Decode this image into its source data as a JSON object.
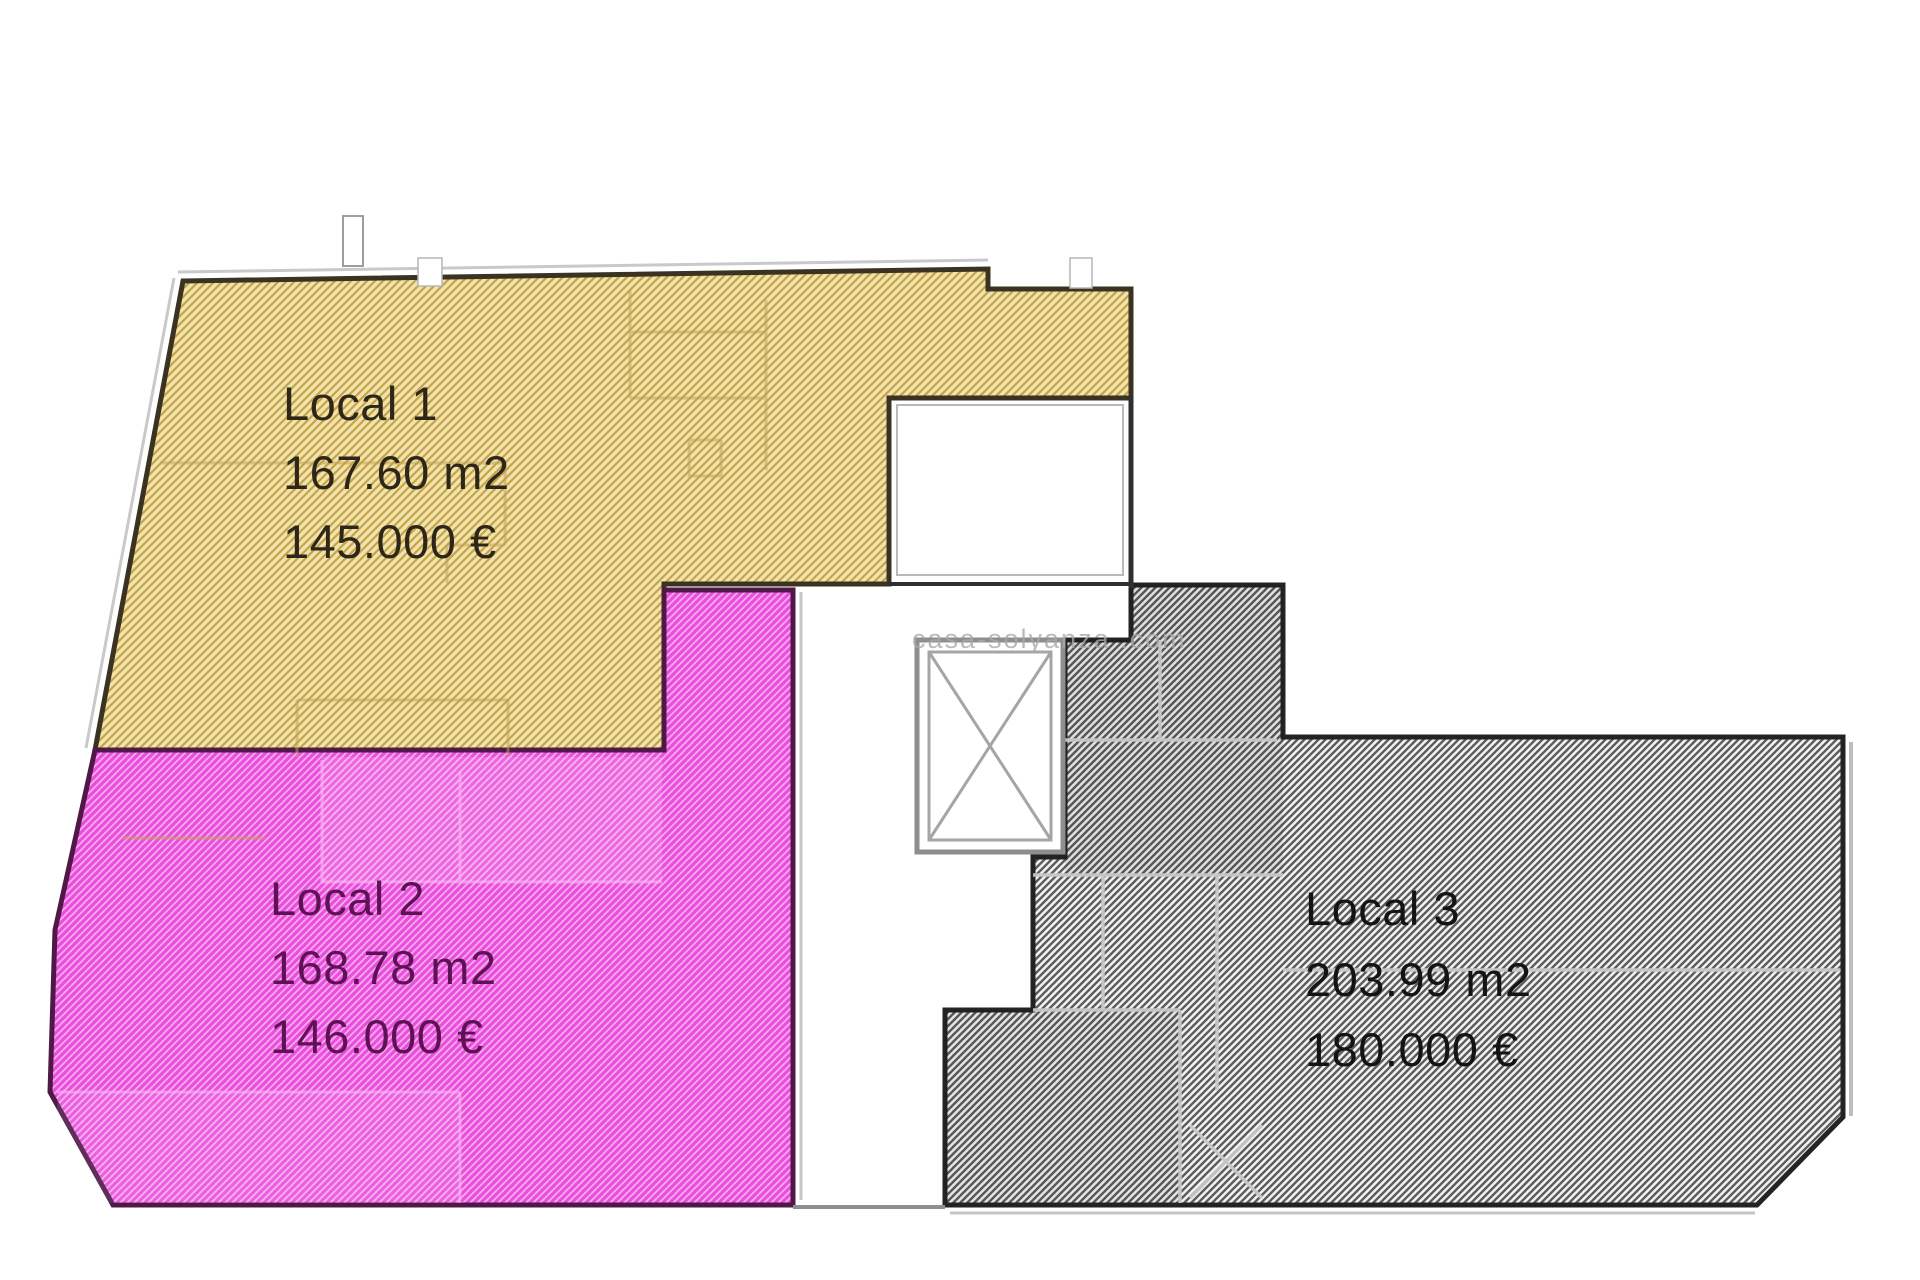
{
  "units": [
    {
      "id": "local-1",
      "name": "Local 1",
      "area": "167.60 m2",
      "price": "145.000 €",
      "colors": {
        "fill_bg": "#f1e4ab",
        "hatch_line": "#c5a24c",
        "border": "#3b3322",
        "text": "#2e2719"
      }
    },
    {
      "id": "local-2",
      "name": "Local 2",
      "area": "168.78 m2",
      "price": "146.000 €",
      "colors": {
        "fill_bg": "#ea4edc",
        "hatch_line": "#f7abef",
        "border": "#4f1847",
        "text": "#5d1254"
      }
    },
    {
      "id": "local-3",
      "name": "Local 3",
      "area": "203.99 m2",
      "price": "180.000 €",
      "colors": {
        "fill_bg": "#f2f2f2",
        "hatch_line": "#5d5d5d",
        "border": "#232323",
        "text": "#141414"
      }
    }
  ],
  "watermark": {
    "text": "casa-solyanza .com",
    "color": "#a9a9a9"
  }
}
